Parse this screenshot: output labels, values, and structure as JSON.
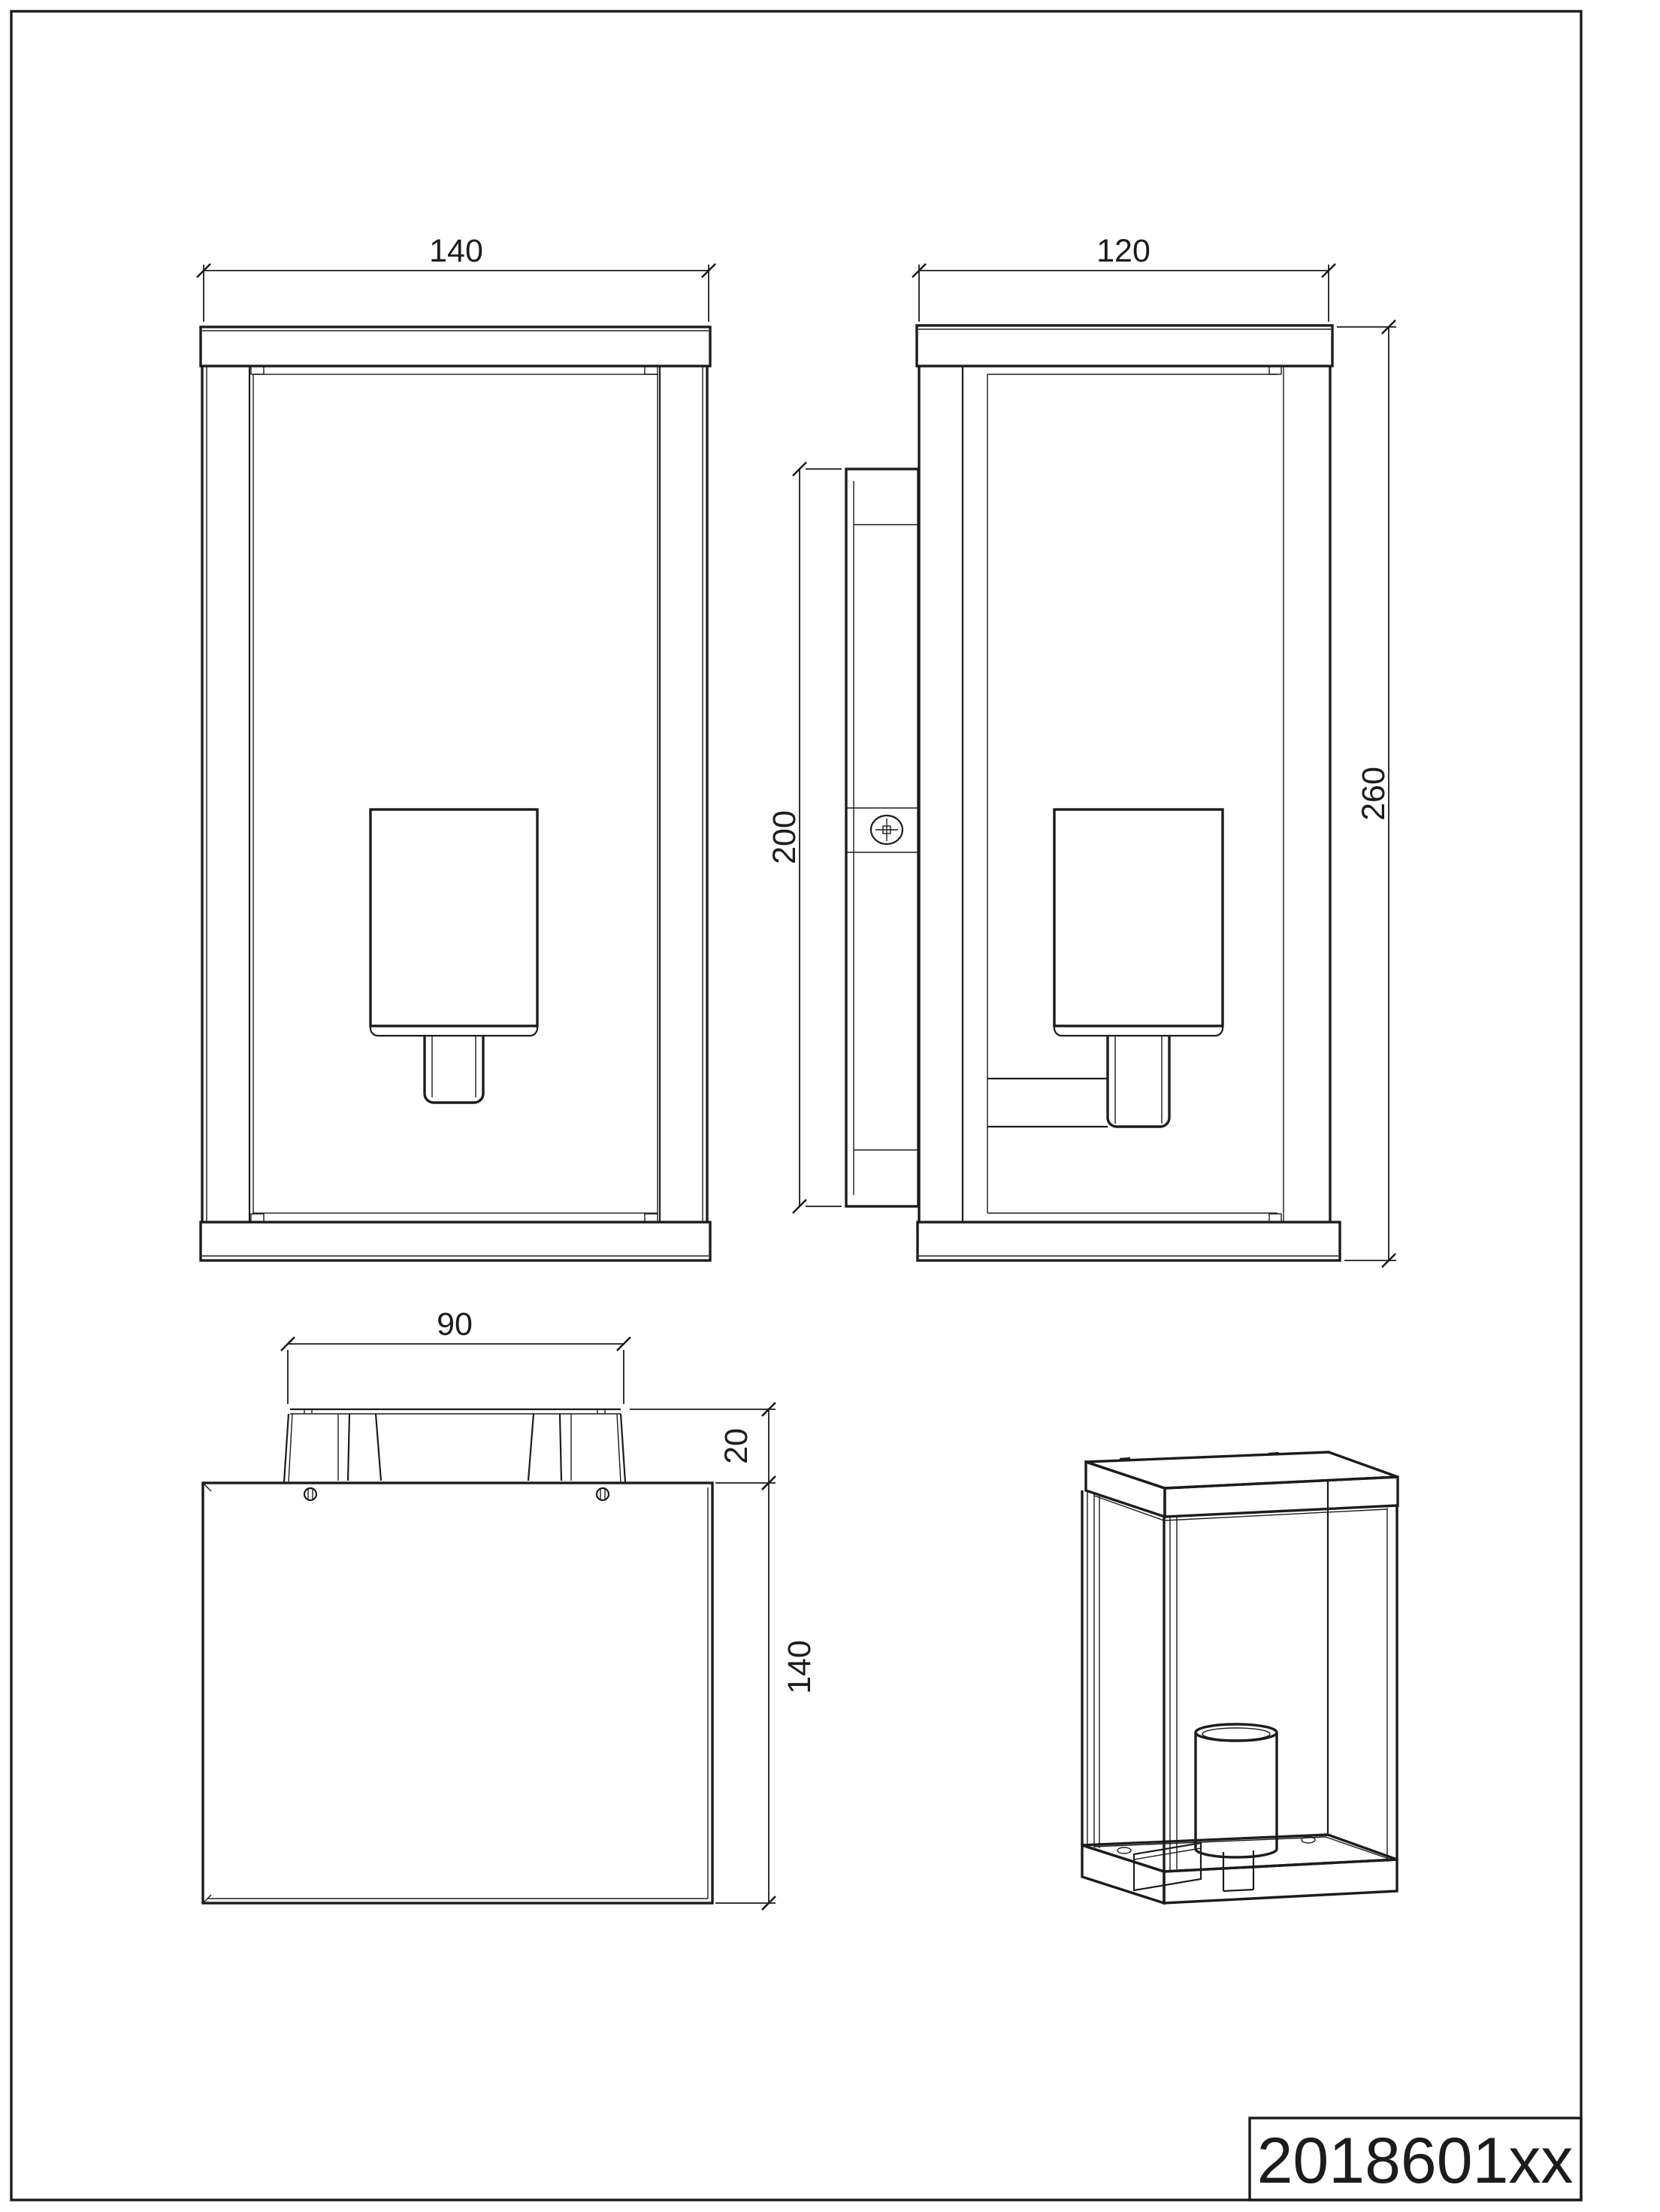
{
  "title_block": {
    "part_number": "2018601xx"
  },
  "views": {
    "front": {
      "width": "140"
    },
    "side": {
      "depth": "120",
      "bracket_height": "200",
      "height": "260"
    },
    "top": {
      "bracket_width": "90",
      "bracket_depth": "20",
      "depth": "140"
    }
  },
  "colors": {
    "line": "#1c1c1c",
    "background": "#ffffff"
  }
}
